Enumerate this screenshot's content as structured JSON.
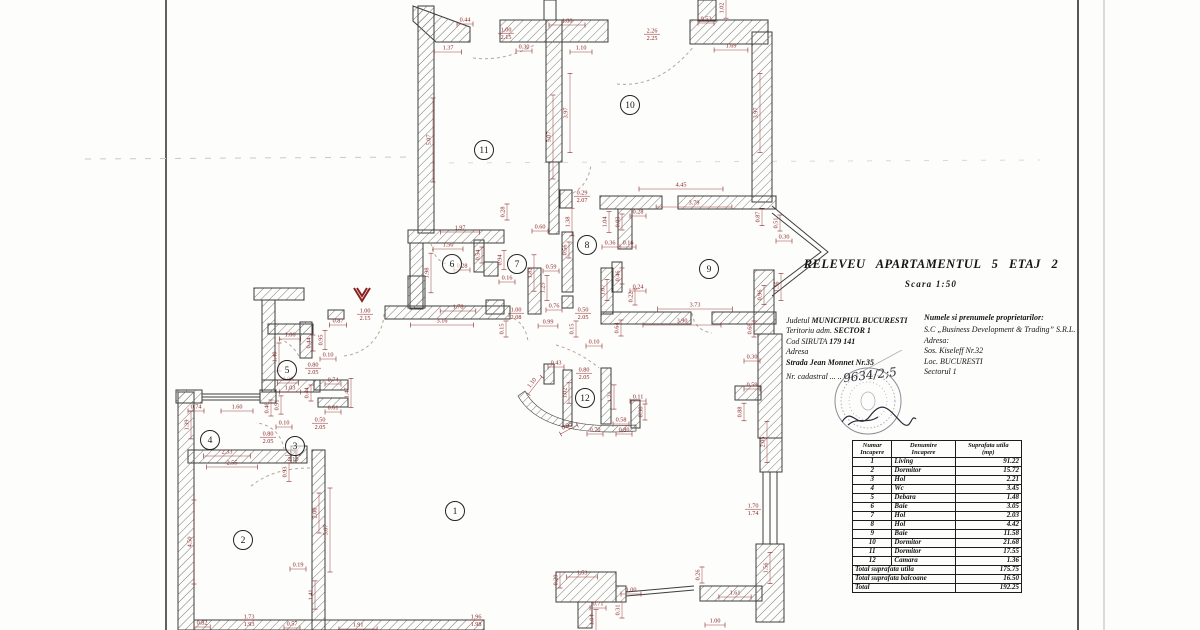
{
  "header": {
    "title": "RELEVEU   APARTAMENTUL  5    ETAJ  2",
    "scale": "Scara  1:50"
  },
  "parcel_info": {
    "county_label": "Judetul",
    "county": "MUNICIPIUL BUCURESTI",
    "territory_label": "Teritoriu adm.",
    "territory": "SECTOR 1",
    "siruta_label": "Cod SIRUTA",
    "siruta": "179 141",
    "address_label": "Adresa",
    "street": "Strada Jean Monnet Nr.35",
    "cadastral_label": "Nr. cadastral ... ..",
    "cadastral_number": "9634/2;5"
  },
  "owner_info": {
    "owner_label": "Numele si prenumele proprietarilor:",
    "owner": "S.C „Business Development & Trading” S.R.L.",
    "address_label": "Adresa:",
    "street": "Sos. Kiseleff Nr.32",
    "city": "Loc.  BUCURESTI",
    "sector": "Sectorul 1"
  },
  "table": {
    "headers": [
      "Numar\nIncapere",
      "Denumire\nIncapere",
      "Suprafata utila\n(mp)"
    ],
    "rows": [
      [
        "1",
        "Living",
        "91.22"
      ],
      [
        "2",
        "Dormitor",
        "15.72"
      ],
      [
        "3",
        "Hol",
        "2.21"
      ],
      [
        "4",
        "Wc",
        "3.45"
      ],
      [
        "5",
        "Debara",
        "1.48"
      ],
      [
        "6",
        "Baie",
        "3.05"
      ],
      [
        "7",
        "Hol",
        "2.03"
      ],
      [
        "8",
        "Hol",
        "4.42"
      ],
      [
        "9",
        "Baie",
        "11.58"
      ],
      [
        "10",
        "Dormitor",
        "21.68"
      ],
      [
        "11",
        "Dormitor",
        "17.55"
      ],
      [
        "12",
        "Camara",
        "1.36"
      ]
    ],
    "totals": [
      [
        "Total suprafata utila",
        "175.75"
      ],
      [
        "Total suprafata balcoane",
        "16.50"
      ],
      [
        "Total",
        "192.25"
      ]
    ]
  },
  "plan": {
    "rooms": [
      {
        "n": "1",
        "x": 455,
        "y": 511
      },
      {
        "n": "2",
        "x": 243,
        "y": 540
      },
      {
        "n": "3",
        "x": 295,
        "y": 446
      },
      {
        "n": "4",
        "x": 210,
        "y": 440
      },
      {
        "n": "5",
        "x": 287,
        "y": 370
      },
      {
        "n": "6",
        "x": 452,
        "y": 264
      },
      {
        "n": "7",
        "x": 517,
        "y": 264
      },
      {
        "n": "8",
        "x": 587,
        "y": 245
      },
      {
        "n": "9",
        "x": 709,
        "y": 269
      },
      {
        "n": "10",
        "x": 630,
        "y": 105
      },
      {
        "n": "11",
        "x": 484,
        "y": 150
      },
      {
        "n": "12",
        "x": 585,
        "y": 398
      }
    ],
    "dimensions": [
      {
        "t": "0.44",
        "x": 465,
        "y": 20
      },
      {
        "t": "1.37",
        "x": 448,
        "y": 48
      },
      {
        "t": "1.00",
        "b": "2.15",
        "x": 506,
        "y": 30
      },
      {
        "t": "1.80",
        "x": 567,
        "y": 21
      },
      {
        "t": "0.30",
        "x": 524,
        "y": 47
      },
      {
        "t": "1.10",
        "x": 581,
        "y": 48
      },
      {
        "t": "2.26",
        "b": "2.25",
        "x": 652,
        "y": 31
      },
      {
        "t": "0.53",
        "x": 706,
        "y": 19
      },
      {
        "t": "1.69",
        "x": 731,
        "y": 46
      },
      {
        "t": "1.02",
        "x": 722,
        "y": 8,
        "v": 1
      },
      {
        "t": "5.07",
        "x": 429,
        "y": 140,
        "v": 1
      },
      {
        "t": "5.07",
        "x": 549,
        "y": 137,
        "v": 1
      },
      {
        "t": "3.97",
        "x": 566,
        "y": 113,
        "v": 1
      },
      {
        "t": "3.97",
        "x": 756,
        "y": 113,
        "v": 1
      },
      {
        "t": "4.45",
        "x": 681,
        "y": 185
      },
      {
        "t": "3.79",
        "x": 694,
        "y": 203
      },
      {
        "t": "0.28",
        "x": 638,
        "y": 212
      },
      {
        "t": "1.04",
        "x": 605,
        "y": 222,
        "v": 1
      },
      {
        "t": "0.03",
        "x": 618,
        "y": 222,
        "v": 1
      },
      {
        "t": "0.16",
        "x": 628,
        "y": 243
      },
      {
        "t": "0.36",
        "x": 610,
        "y": 243
      },
      {
        "t": "0.87",
        "x": 758,
        "y": 217,
        "v": 1
      },
      {
        "t": "0.51",
        "x": 776,
        "y": 223,
        "v": 1
      },
      {
        "t": "0.30",
        "x": 784,
        "y": 237
      },
      {
        "t": "1.97",
        "x": 460,
        "y": 228
      },
      {
        "t": "0.28",
        "x": 503,
        "y": 212,
        "v": 1
      },
      {
        "t": "0.60",
        "x": 540,
        "y": 227
      },
      {
        "t": "1.38",
        "x": 568,
        "y": 222,
        "v": 1
      },
      {
        "t": "0.29",
        "b": "2.07",
        "x": 582,
        "y": 193
      },
      {
        "t": "1.50",
        "x": 448,
        "y": 245
      },
      {
        "t": "0.54",
        "x": 478,
        "y": 255,
        "v": 1
      },
      {
        "t": "0.28",
        "x": 462,
        "y": 266
      },
      {
        "t": "0.94",
        "x": 500,
        "y": 260,
        "v": 1
      },
      {
        "t": "0.16",
        "x": 507,
        "y": 278
      },
      {
        "t": "1.98",
        "x": 427,
        "y": 273,
        "v": 1
      },
      {
        "t": "0.56",
        "x": 565,
        "y": 250,
        "v": 1
      },
      {
        "t": "0.59",
        "x": 551,
        "y": 267
      },
      {
        "t": "1.25",
        "x": 543,
        "y": 288,
        "v": 1
      },
      {
        "t": "1.82",
        "x": 530,
        "y": 273,
        "v": 1
      },
      {
        "t": "1.78",
        "x": 458,
        "y": 307
      },
      {
        "t": "3.16",
        "x": 442,
        "y": 321
      },
      {
        "t": "0.76",
        "x": 554,
        "y": 306
      },
      {
        "t": "0.99",
        "x": 548,
        "y": 322
      },
      {
        "t": "0.15",
        "x": 572,
        "y": 329,
        "v": 1
      },
      {
        "t": "0.15",
        "x": 502,
        "y": 329,
        "v": 1
      },
      {
        "t": "0.50",
        "b": "2.05",
        "x": 583,
        "y": 310
      },
      {
        "t": "3.73",
        "x": 695,
        "y": 305
      },
      {
        "t": "3.90",
        "x": 682,
        "y": 321
      },
      {
        "t": "0.24",
        "x": 638,
        "y": 287
      },
      {
        "t": "0.46",
        "x": 618,
        "y": 276,
        "v": 1
      },
      {
        "t": "0.22",
        "x": 631,
        "y": 297,
        "v": 1
      },
      {
        "t": "1.07",
        "x": 603,
        "y": 290,
        "v": 1
      },
      {
        "t": "0.64",
        "x": 617,
        "y": 328,
        "v": 1
      },
      {
        "t": "0.96",
        "x": 760,
        "y": 295,
        "v": 1
      },
      {
        "t": "1.36",
        "x": 777,
        "y": 287,
        "v": 1
      },
      {
        "t": "0.68",
        "x": 750,
        "y": 329,
        "v": 1
      },
      {
        "t": "1.00",
        "b": "2.15",
        "x": 365,
        "y": 311
      },
      {
        "t": "0.87",
        "x": 338,
        "y": 321
      },
      {
        "t": "1.00",
        "b": "2.08",
        "x": 516,
        "y": 310
      },
      {
        "t": "1.06",
        "x": 290,
        "y": 335
      },
      {
        "t": "0.95",
        "x": 321,
        "y": 340,
        "v": 1
      },
      {
        "t": "0.44",
        "x": 309,
        "y": 343,
        "v": 1
      },
      {
        "t": "0.10",
        "x": 328,
        "y": 355
      },
      {
        "t": "0.80",
        "b": "2.05",
        "x": 313,
        "y": 365
      },
      {
        "t": "1.06",
        "x": 288,
        "y": 379
      },
      {
        "t": "1.03",
        "x": 290,
        "y": 388
      },
      {
        "t": "1.40",
        "x": 275,
        "y": 357,
        "v": 1
      },
      {
        "t": "0.74",
        "x": 333,
        "y": 380
      },
      {
        "t": "0.61",
        "x": 333,
        "y": 408
      },
      {
        "t": "0.44",
        "x": 307,
        "y": 393,
        "v": 1
      },
      {
        "t": "1.47",
        "x": 347,
        "y": 393,
        "v": 1
      },
      {
        "t": "0.74",
        "x": 196,
        "y": 407
      },
      {
        "t": "1.60",
        "x": 237,
        "y": 407
      },
      {
        "t": "1.39",
        "x": 187,
        "y": 425,
        "v": 1
      },
      {
        "t": "0.46",
        "x": 267,
        "y": 408,
        "v": 1
      },
      {
        "t": "0.91",
        "x": 277,
        "y": 405,
        "v": 1
      },
      {
        "t": "0.10",
        "x": 284,
        "y": 423
      },
      {
        "t": "0.80",
        "b": "2.05",
        "x": 268,
        "y": 434
      },
      {
        "t": "0.50",
        "b": "2.05",
        "x": 320,
        "y": 420
      },
      {
        "t": "2.33",
        "x": 227,
        "y": 452
      },
      {
        "t": "2.55",
        "x": 232,
        "y": 463
      },
      {
        "t": "0.90",
        "b": "2.10",
        "x": 293,
        "y": 452
      },
      {
        "t": "0.93",
        "x": 285,
        "y": 472,
        "v": 1
      },
      {
        "t": "4.50",
        "x": 190,
        "y": 542,
        "v": 1
      },
      {
        "t": "2.00",
        "x": 315,
        "y": 513,
        "v": 1
      },
      {
        "t": "5.07",
        "x": 326,
        "y": 530,
        "v": 1
      },
      {
        "t": "0.19",
        "x": 298,
        "y": 565
      },
      {
        "t": "1.41",
        "x": 311,
        "y": 595,
        "v": 1
      },
      {
        "t": "0.82",
        "x": 202,
        "y": 623
      },
      {
        "t": "1.73",
        "b": "1.93",
        "x": 249,
        "y": 617
      },
      {
        "t": "0.57",
        "x": 292,
        "y": 624
      },
      {
        "t": "1.91",
        "x": 358,
        "y": 625
      },
      {
        "t": "1.96",
        "b": "1.98",
        "x": 476,
        "y": 617
      },
      {
        "t": "0.43",
        "x": 556,
        "y": 363
      },
      {
        "t": "1.10",
        "x": 532,
        "y": 383,
        "r": -52
      },
      {
        "t": "0.80",
        "b": "2.05",
        "x": 584,
        "y": 370
      },
      {
        "t": "1.02",
        "x": 565,
        "y": 393,
        "v": 1
      },
      {
        "t": "0.11",
        "x": 638,
        "y": 397
      },
      {
        "t": "1.21",
        "x": 610,
        "y": 397,
        "v": 1
      },
      {
        "t": "0.58",
        "x": 621,
        "y": 420
      },
      {
        "t": "0.95",
        "x": 567,
        "y": 426,
        "r": -28
      },
      {
        "t": "0.70",
        "x": 595,
        "y": 430
      },
      {
        "t": "0.80",
        "x": 624,
        "y": 430
      },
      {
        "t": "0.38",
        "x": 641,
        "y": 412,
        "v": 1
      },
      {
        "t": "0.10",
        "x": 594,
        "y": 342
      },
      {
        "t": "0.30",
        "x": 752,
        "y": 357
      },
      {
        "t": "0.59",
        "x": 752,
        "y": 385
      },
      {
        "t": "0.88",
        "x": 740,
        "y": 412,
        "v": 1
      },
      {
        "t": "2.05",
        "x": 763,
        "y": 442,
        "v": 1
      },
      {
        "t": "1.70",
        "b": "1.74",
        "x": 753,
        "y": 506
      },
      {
        "t": "1.56",
        "x": 766,
        "y": 568,
        "v": 1
      },
      {
        "t": "0.26",
        "x": 698,
        "y": 575,
        "v": 1
      },
      {
        "t": "1.61",
        "x": 735,
        "y": 593
      },
      {
        "t": "1.00",
        "x": 715,
        "y": 621
      },
      {
        "t": "1.53",
        "x": 582,
        "y": 573
      },
      {
        "t": "0.29",
        "x": 556,
        "y": 580,
        "v": 1
      },
      {
        "t": "1.00",
        "x": 631,
        "y": 590
      },
      {
        "t": "0.71",
        "x": 598,
        "y": 604
      },
      {
        "t": "0.31",
        "x": 618,
        "y": 610,
        "v": 1
      },
      {
        "t": "1.04",
        "x": 592,
        "y": 620,
        "v": 1
      }
    ]
  }
}
